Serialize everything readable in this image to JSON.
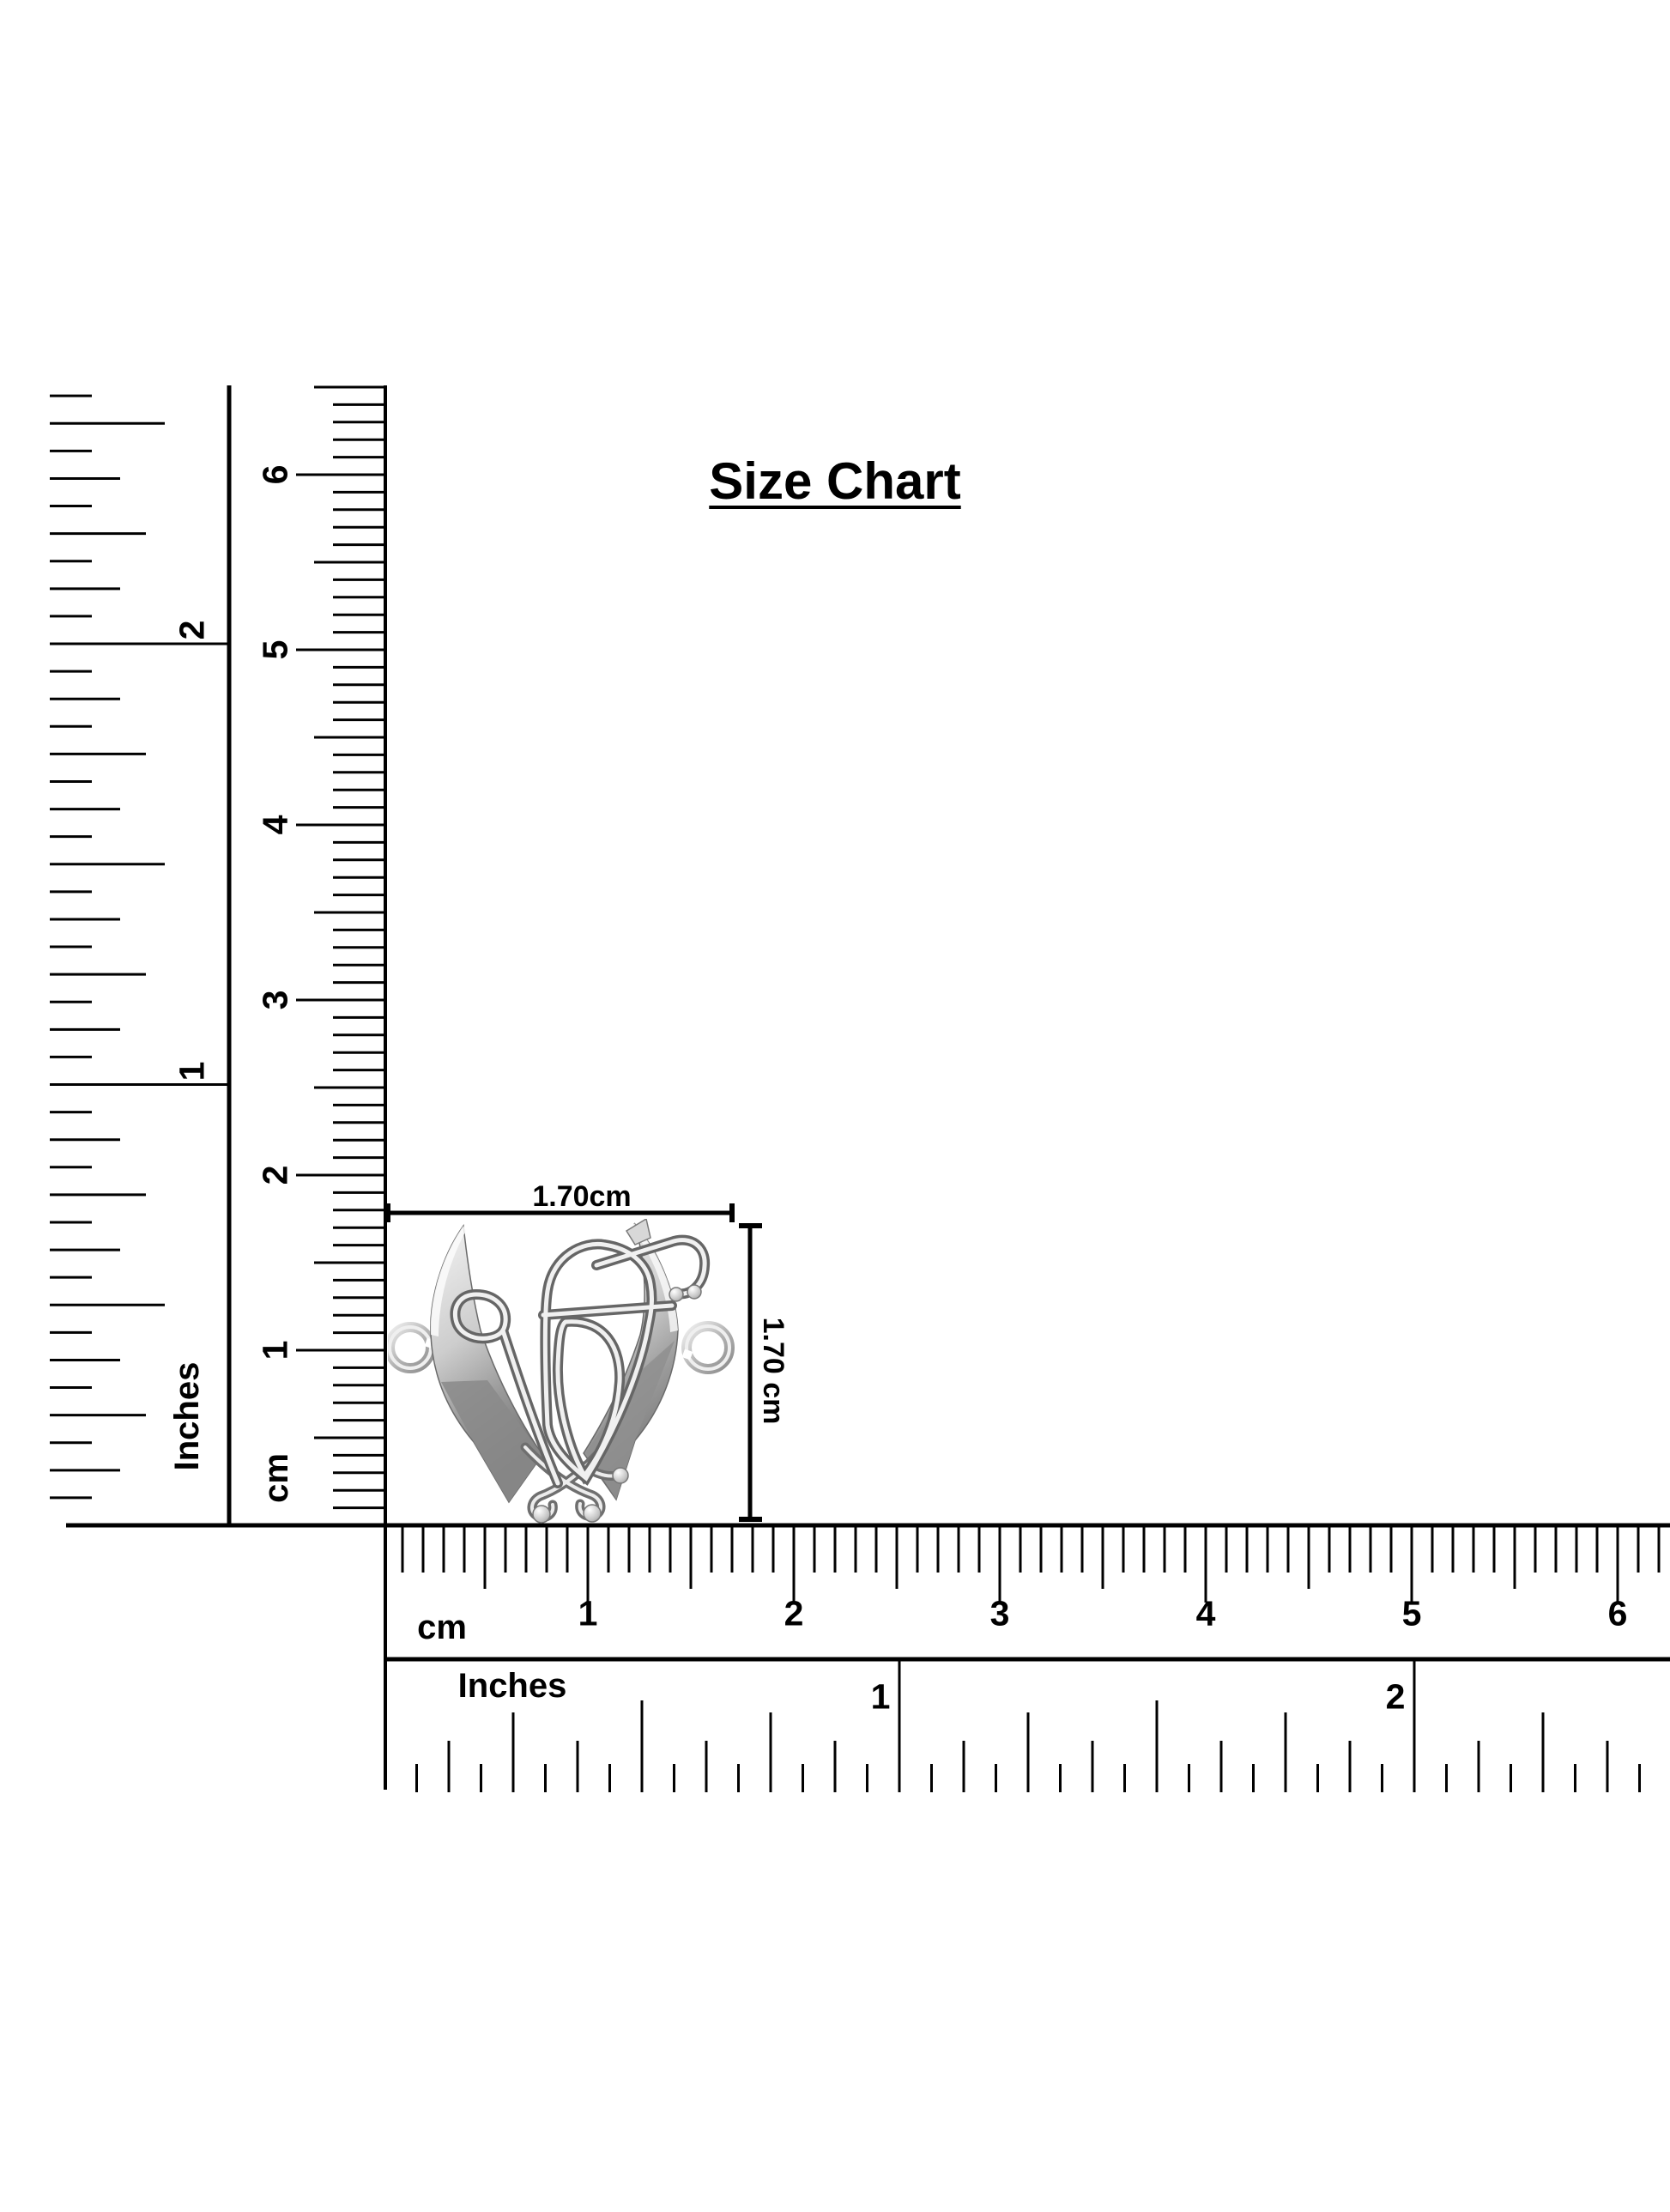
{
  "title": "Size Chart",
  "pendant": {
    "width_label": "1.70cm",
    "height_label": "1.70 cm"
  },
  "vertical_ruler": {
    "inch_unit": "Inches",
    "inch_labels": [
      "2",
      "1"
    ],
    "cm_unit": "cm",
    "cm_labels": [
      "6",
      "5",
      "4",
      "3",
      "2",
      "1"
    ]
  },
  "horizontal_cm_ruler": {
    "unit": "cm",
    "labels": [
      "1",
      "2",
      "3",
      "4",
      "5",
      "6"
    ]
  },
  "horizontal_inch_ruler": {
    "unit": "Inches",
    "labels": [
      "1",
      "2"
    ]
  },
  "colors": {
    "ink": "#000000",
    "background": "#ffffff",
    "metal_light": "#f5f5f5",
    "metal_mid": "#c0c0c0",
    "metal_dark": "#787878"
  }
}
